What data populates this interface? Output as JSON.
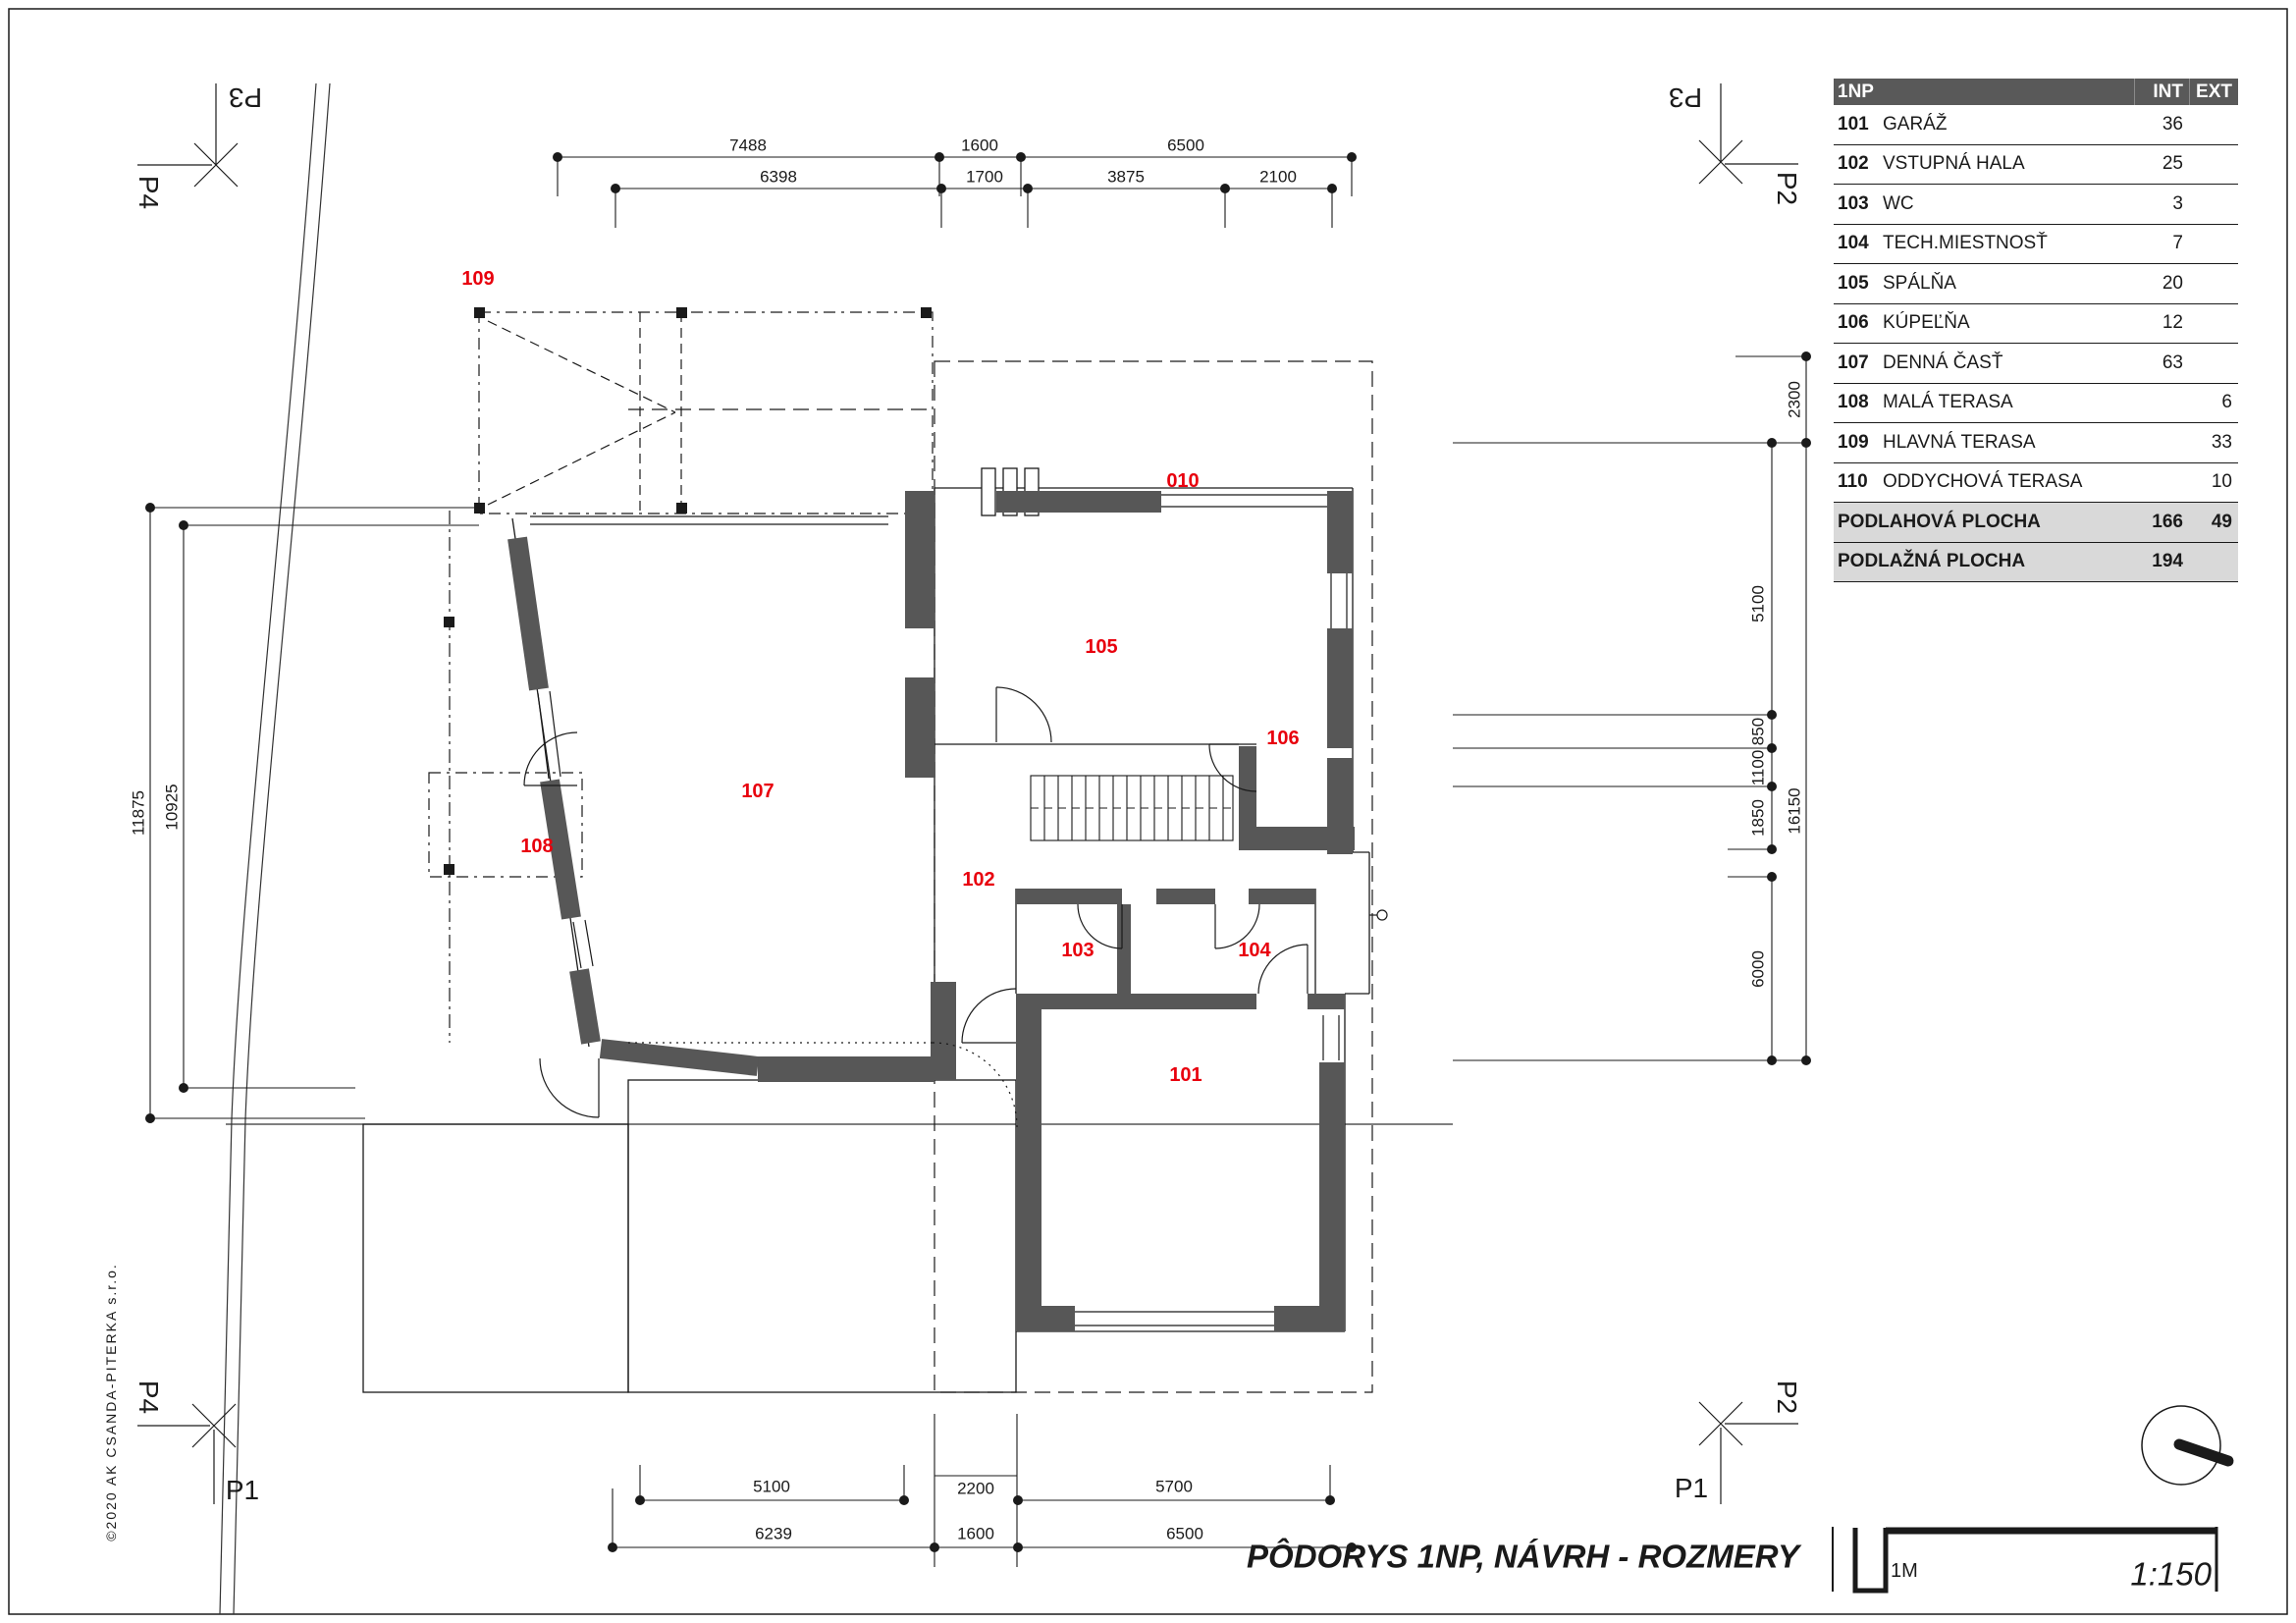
{
  "sheet": {
    "title": "PÔDORYS 1NP, NÁVRH - ROZMERY",
    "scale": "1:150",
    "scale_bar_unit": "1M",
    "copyright": "©2020 AK CSANDA-PITERKA s.r.o."
  },
  "sections": {
    "p1": "P1",
    "p2": "P2",
    "p3": "P3",
    "p4": "P4"
  },
  "rooms": {
    "r101": "101",
    "r102": "102",
    "r103": "103",
    "r104": "104",
    "r105": "105",
    "r106": "106",
    "r107": "107",
    "r108": "108",
    "r109": "109",
    "r010": "010"
  },
  "dims": {
    "top_row1": [
      "7488",
      "1600",
      "6500"
    ],
    "top_row2": [
      "6398",
      "1700",
      "3875",
      "2100"
    ],
    "bottom_row1": [
      "5100",
      "2200",
      "5700"
    ],
    "bottom_row2": [
      "6239",
      "1600",
      "6500"
    ],
    "left": [
      "11875",
      "10925"
    ],
    "right_outer": [
      "2300",
      "16150"
    ],
    "right_inner": [
      "5100",
      "850",
      "1100",
      "1850",
      "6000"
    ]
  },
  "legend": {
    "header": {
      "level": "1NP",
      "int": "INT",
      "ext": "EXT"
    },
    "rows": [
      {
        "num": "101",
        "name": "GARÁŽ",
        "int": "36",
        "ext": ""
      },
      {
        "num": "102",
        "name": "VSTUPNÁ HALA",
        "int": "25",
        "ext": ""
      },
      {
        "num": "103",
        "name": "WC",
        "int": "3",
        "ext": ""
      },
      {
        "num": "104",
        "name": "TECH.MIESTNOSŤ",
        "int": "7",
        "ext": ""
      },
      {
        "num": "105",
        "name": "SPÁLŇA",
        "int": "20",
        "ext": ""
      },
      {
        "num": "106",
        "name": "KÚPEĽŇA",
        "int": "12",
        "ext": ""
      },
      {
        "num": "107",
        "name": "DENNÁ ČASŤ",
        "int": "63",
        "ext": ""
      },
      {
        "num": "108",
        "name": "MALÁ TERASA",
        "int": "",
        "ext": "6"
      },
      {
        "num": "109",
        "name": "HLAVNÁ TERASA",
        "int": "",
        "ext": "33"
      },
      {
        "num": "110",
        "name": "ODDYCHOVÁ TERASA",
        "int": "",
        "ext": "10"
      }
    ],
    "summary": [
      {
        "name": "PODLAHOVÁ PLOCHA",
        "int": "166",
        "ext": "49"
      },
      {
        "name": "PODLAŽNÁ PLOCHA",
        "int": "194",
        "ext": ""
      }
    ]
  },
  "colors": {
    "wall": "#575757",
    "room_label": "#e8000d",
    "table_header_bg": "#595959",
    "summary_bg": "#d9d9d9"
  }
}
